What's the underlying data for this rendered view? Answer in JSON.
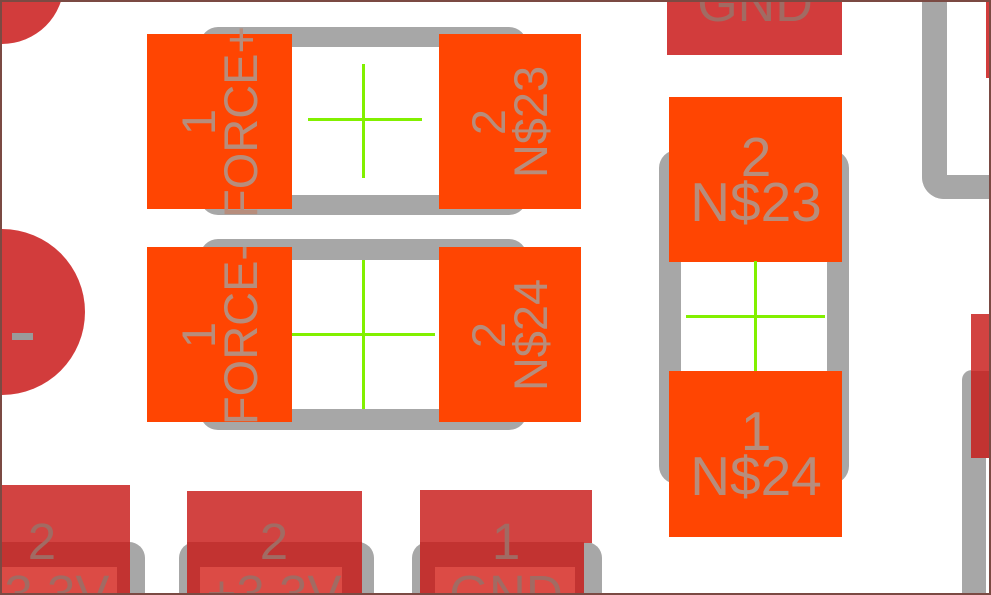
{
  "view": {
    "type": "pcb-layout-editor-viewport",
    "background": "#ffffff",
    "frame_color": "#7b4a43"
  },
  "colors": {
    "smd_pad_orange": "#ff4502",
    "pad_red": "#d24341",
    "pad_red_dark": "#c23331",
    "pad_red_light": "#dc4b45",
    "pad_crimson": "#d23c3c",
    "silkscreen_gray": "#a7a7a7",
    "origin_cross_green": "#82f000",
    "label_on_orange": "#b78d7c",
    "label_on_red": "#a16b63"
  },
  "components": {
    "res_top": {
      "pads": [
        {
          "number": "1",
          "net": "FORCE+"
        },
        {
          "number": "2",
          "net": "N$23"
        }
      ]
    },
    "res_mid": {
      "pads": [
        {
          "number": "1",
          "net": "FORCE-"
        },
        {
          "number": "2",
          "net": "N$24"
        }
      ]
    },
    "res_right": {
      "pads": [
        {
          "number": "2",
          "net": "N$23"
        },
        {
          "number": "1",
          "net": "N$24"
        }
      ]
    },
    "header_top": {
      "net": "GND"
    },
    "header_bottom": {
      "pads": [
        {
          "number": "2",
          "net": "+3.3V"
        },
        {
          "number": "2",
          "net": "+3.3V"
        },
        {
          "number": "1",
          "net": "GND"
        }
      ]
    }
  }
}
